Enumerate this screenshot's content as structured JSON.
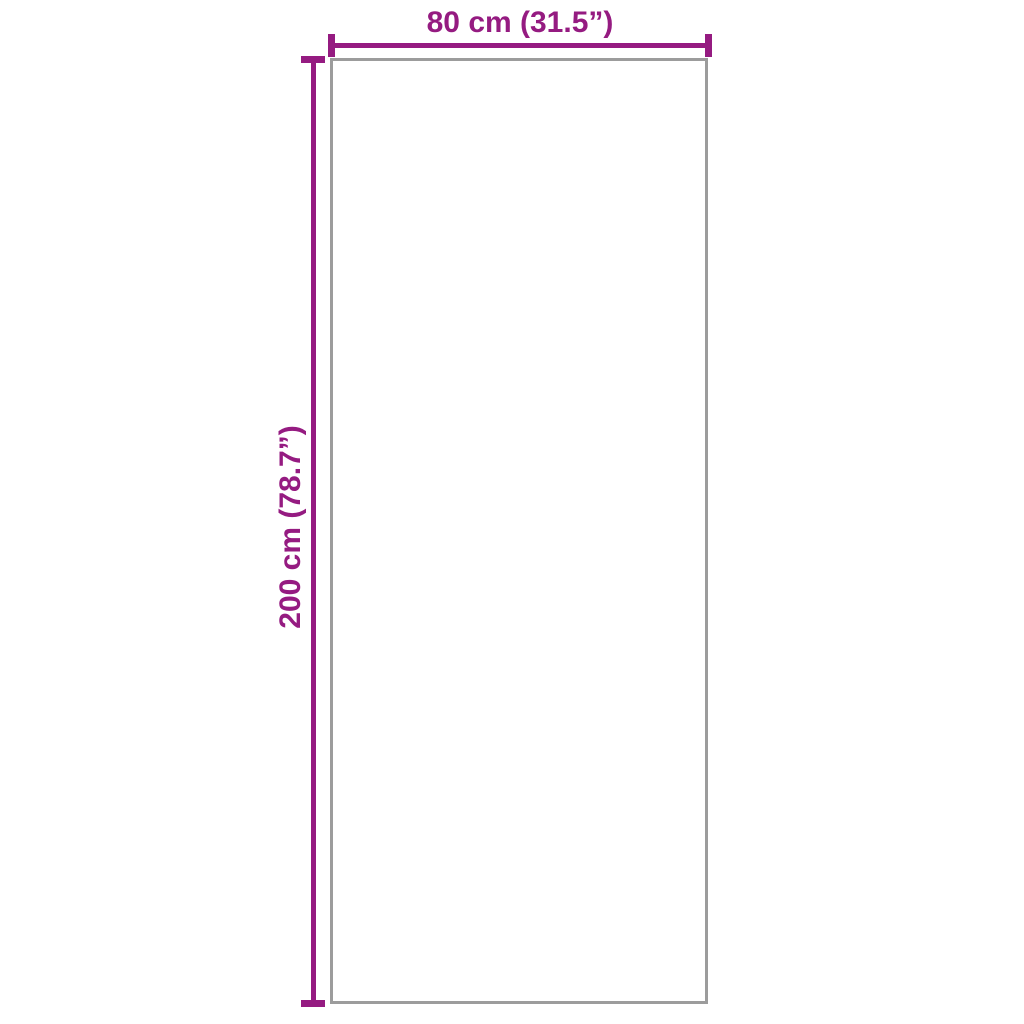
{
  "diagram": {
    "type": "product-dimension-diagram",
    "background_color": "#ffffff",
    "accent_color": "#951b81",
    "outline_color": "#9c9c9c",
    "width_dimension": {
      "label": "80 cm (31.5”)",
      "value_cm": 80,
      "value_inches": 31.5
    },
    "height_dimension": {
      "label": "200 cm (78.7”)",
      "value_cm": 200,
      "value_inches": 78.7
    }
  }
}
